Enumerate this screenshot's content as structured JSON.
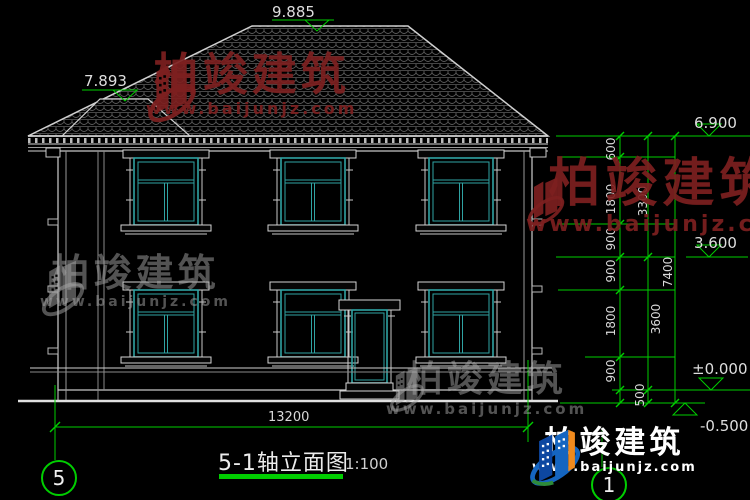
{
  "title_block": {
    "title": "5-1轴立面图",
    "scale": "1:100"
  },
  "axes": {
    "left": "5",
    "right": "1"
  },
  "levels": {
    "ridge": "9.885",
    "left_ridge": "7.893",
    "eave": "6.900",
    "floor2": "3.600",
    "ground": "±0.000",
    "outdoor": "-0.500"
  },
  "dimensions": {
    "width_total": "13200",
    "height_total": "7400",
    "height_mid": [
      "3300",
      "3600"
    ],
    "height_inner": [
      "600",
      "1800",
      "900",
      "900",
      "1800",
      "900",
      "500"
    ]
  },
  "brand": {
    "name": "柏竣建筑",
    "site": "www.baijunjz.com"
  }
}
